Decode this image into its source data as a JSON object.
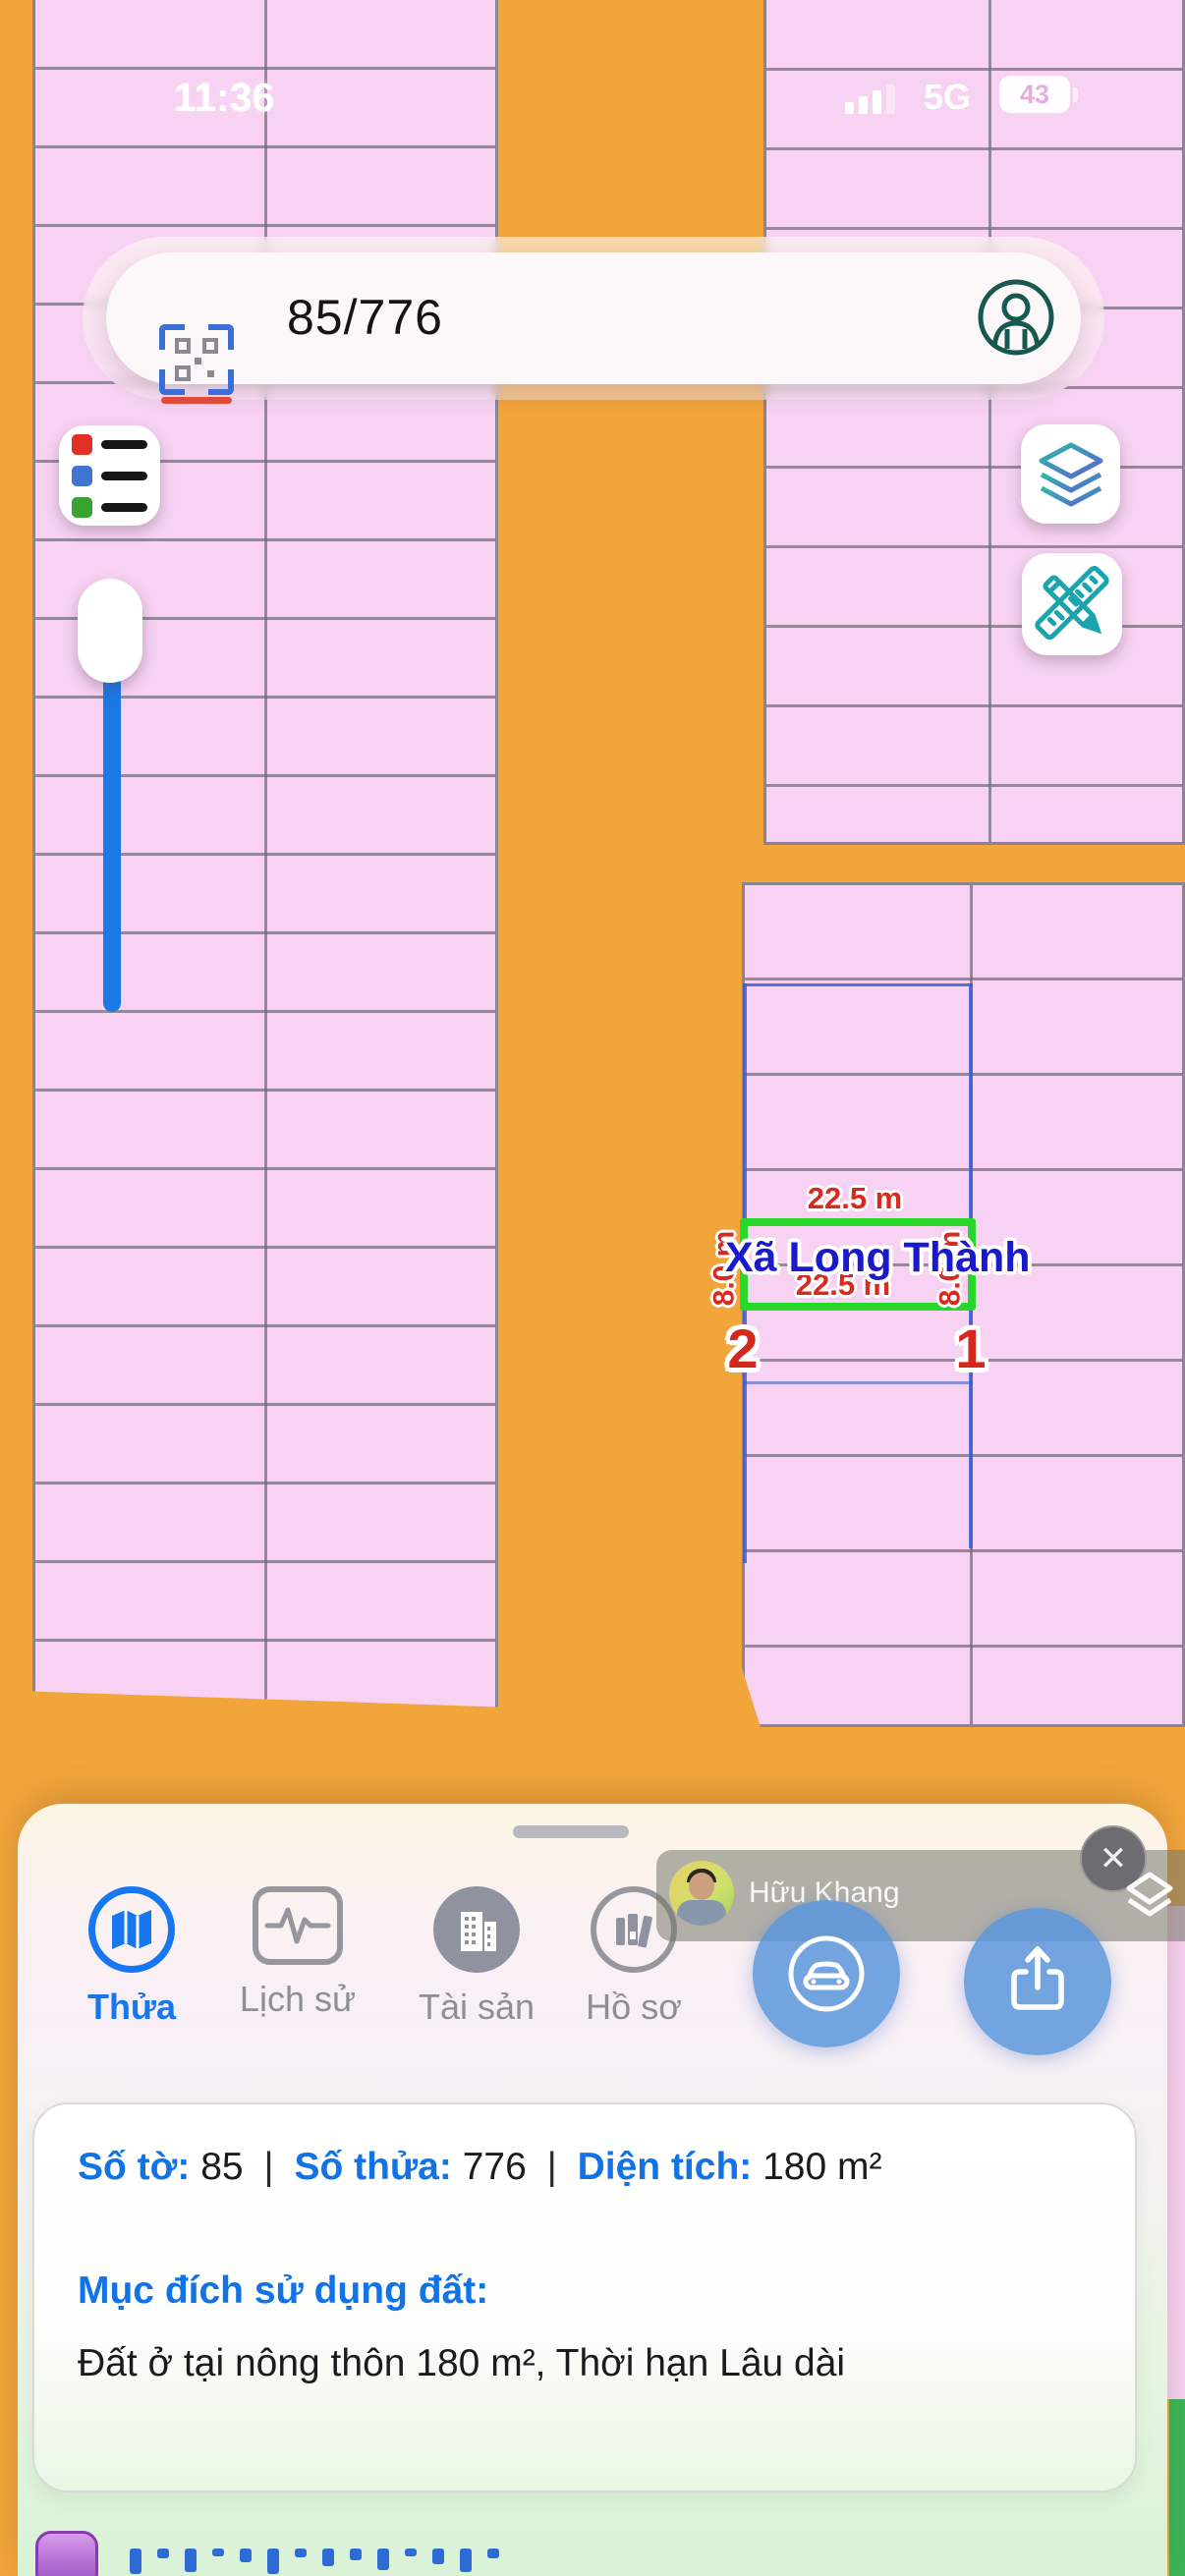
{
  "status_bar": {
    "time": "11:36",
    "network": "5G",
    "battery_percent": "43"
  },
  "search_bar": {
    "query": "85/776"
  },
  "map": {
    "parcel_label": "Xã Long Thành",
    "dim_top": "22.5 m",
    "dim_bottom": "22.5 m",
    "dim_left": "8.0 m",
    "dim_right": "8.0 m",
    "vertex_1": "1",
    "vertex_2": "2"
  },
  "sheet": {
    "tabs": [
      {
        "label": "Thửa"
      },
      {
        "label": "Lịch sử"
      },
      {
        "label": "Tài sản"
      },
      {
        "label": "Hồ sơ"
      }
    ],
    "active_tab": "Thửa",
    "user_overlay": {
      "name": "Hữu Khang"
    },
    "close_glyph": "✕",
    "info_card": {
      "sheet_label": "Số tờ:",
      "sheet_value": "85",
      "parcel_no_label": "Số thửa:",
      "parcel_no_value": "776",
      "area_label": "Diện tích:",
      "area_value": "180 m²",
      "separator": "|",
      "purpose_label": "Mục đích sử dụng đất:",
      "purpose_value": "Đất ở tại nông thôn 180 m², Thời hạn Lâu dài"
    }
  },
  "colors": {
    "accent_blue": "#1677f0",
    "road_orange": "#f2a53b",
    "parcel_pink": "#f7d2f2",
    "highlight_green": "#27d82b",
    "measure_red": "#d62b20",
    "parcel_label_blue": "#1a1acc"
  }
}
